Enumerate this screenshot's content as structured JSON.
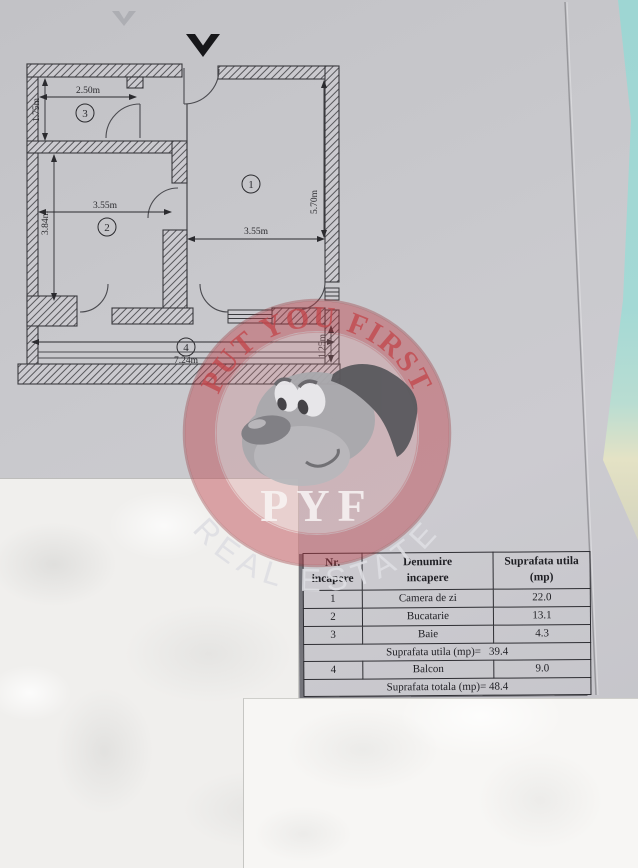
{
  "plan": {
    "north_arrow": "V",
    "rooms": {
      "r1": "1",
      "r2": "2",
      "r3": "3",
      "r4": "4"
    },
    "dims": {
      "room3_w": "2.50m",
      "room3_h": "1.75m",
      "room2_w": "3.55m",
      "room2_h": "3.84m",
      "room1_w": "3.55m",
      "room1_h": "5.70m",
      "balcony_w": "7.24m",
      "balcony_d": "1.25m"
    }
  },
  "watermark": {
    "top_arc": "PUT YOU FIRST",
    "monogram": "PYF",
    "bottom_arc": "REAL ESTATE"
  },
  "area_table": {
    "headers": {
      "col1_line1": "Nr.",
      "col1_line2": "incapere",
      "col2_line1": "Denumire",
      "col2_line2": "incapere",
      "col3_line1": "Suprafata utila",
      "col3_line2": "(mp)"
    },
    "rows": [
      {
        "nr": "1",
        "name": "Camera de zi",
        "area": "22.0"
      },
      {
        "nr": "2",
        "name": "Bucatarie",
        "area": "13.1"
      },
      {
        "nr": "3",
        "name": "Baie",
        "area": "4.3"
      }
    ],
    "subtotal_label": "Suprafata utila (mp)=",
    "subtotal_value": "39.4",
    "balcony_row": {
      "nr": "4",
      "name": "Balcon",
      "area": "9.0"
    },
    "total_label": "Suprafata totala (mp)=",
    "total_value": "48.4"
  },
  "colors": {
    "teal_bg": "#9ed6d3",
    "paper_grey": "#c7c7cb",
    "watermark_red": "#ba3e46",
    "sheet_white": "#f0efed"
  }
}
